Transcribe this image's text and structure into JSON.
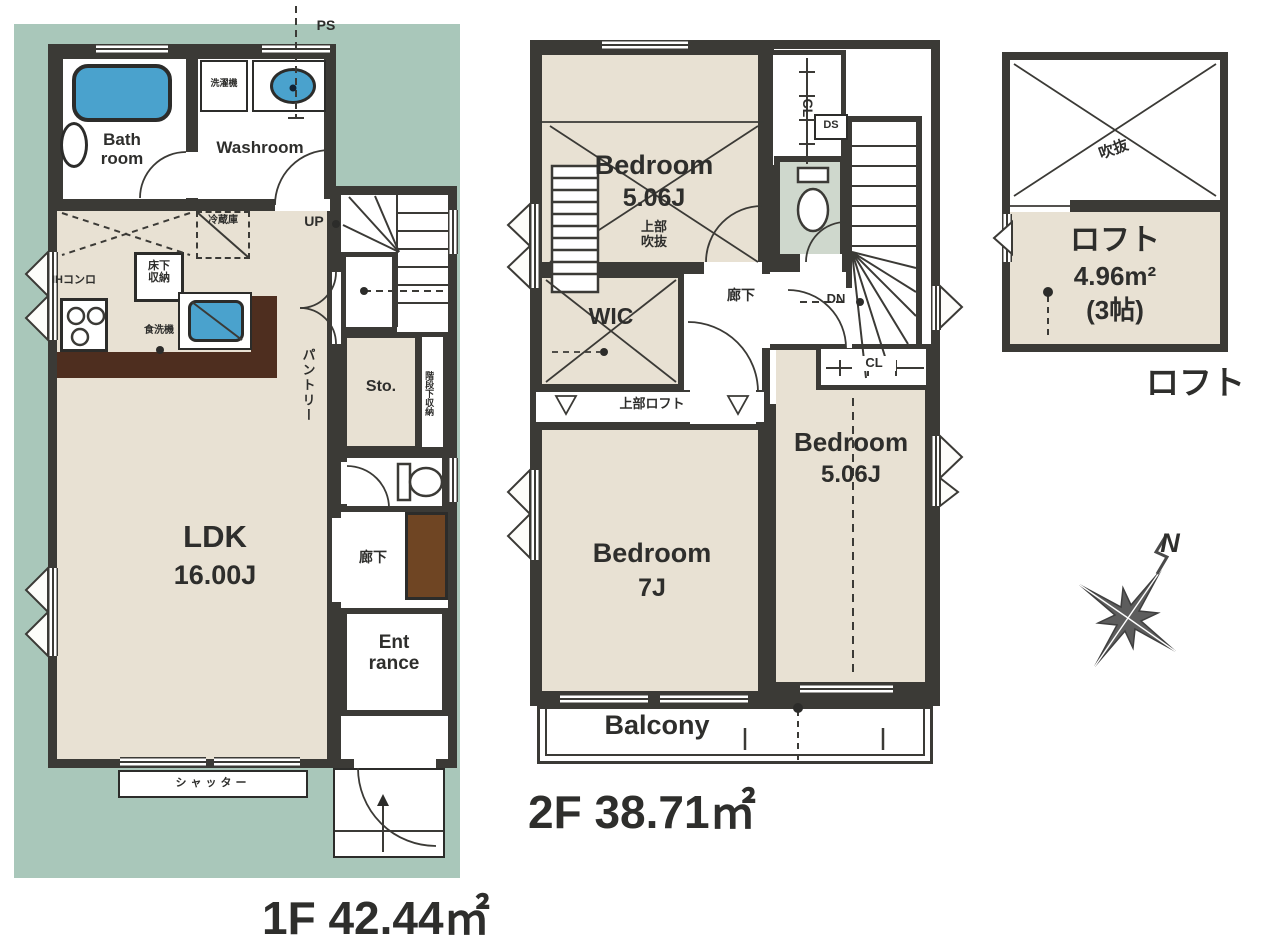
{
  "colors": {
    "site_bg": "#a9c7ba",
    "wall": "#3b3a36",
    "room_beige": "#e8e1d3",
    "fixture_blue": "#4aa2cd",
    "counter_brown": "#4e2e1f",
    "cabinet_brown": "#6f4523",
    "toilet_floor": "#cfd8cd"
  },
  "floor1": {
    "caption": "1F 42.44㎡",
    "labels": {
      "ps": "PS",
      "washer": "洗濯機",
      "bathroom": "Bath\nroom",
      "washroom": "Washroom",
      "fridge": "冷蔵庫",
      "underfloor_storage": "床下\n収納",
      "ih_stove": "IHコンロ",
      "dishwasher": "食洗機",
      "up": "UP",
      "pantry": "パントリー",
      "storage": "Sto.",
      "under_stairs_storage": "階段下収納",
      "hallway": "廊下",
      "ldk": "LDK",
      "ldk_size": "16.00J",
      "entrance": "Ent\nrance",
      "shutter": "シャッター"
    }
  },
  "floor2": {
    "caption": "2F 38.71㎡",
    "labels": {
      "bedroom_a": "Bedroom",
      "bedroom_a_size": "5.06J",
      "bedroom_a_note": "上部\n吹抜",
      "closet_a": "CL",
      "duct_space": "DS",
      "hallway": "廊下",
      "down": "DN",
      "wic": "WIC",
      "loft_above": "上部ロフト",
      "bedroom_b": "Bedroom",
      "bedroom_b_size": "7J",
      "bedroom_c": "Bedroom",
      "bedroom_c_size": "5.06J",
      "closet_b": "CL",
      "balcony": "Balcony"
    }
  },
  "loft": {
    "caption": "ロフト",
    "labels": {
      "void": "吹抜",
      "name": "ロフト",
      "area": "4.96m²",
      "tatami": "(3帖)"
    }
  },
  "compass": {
    "north": "N"
  }
}
